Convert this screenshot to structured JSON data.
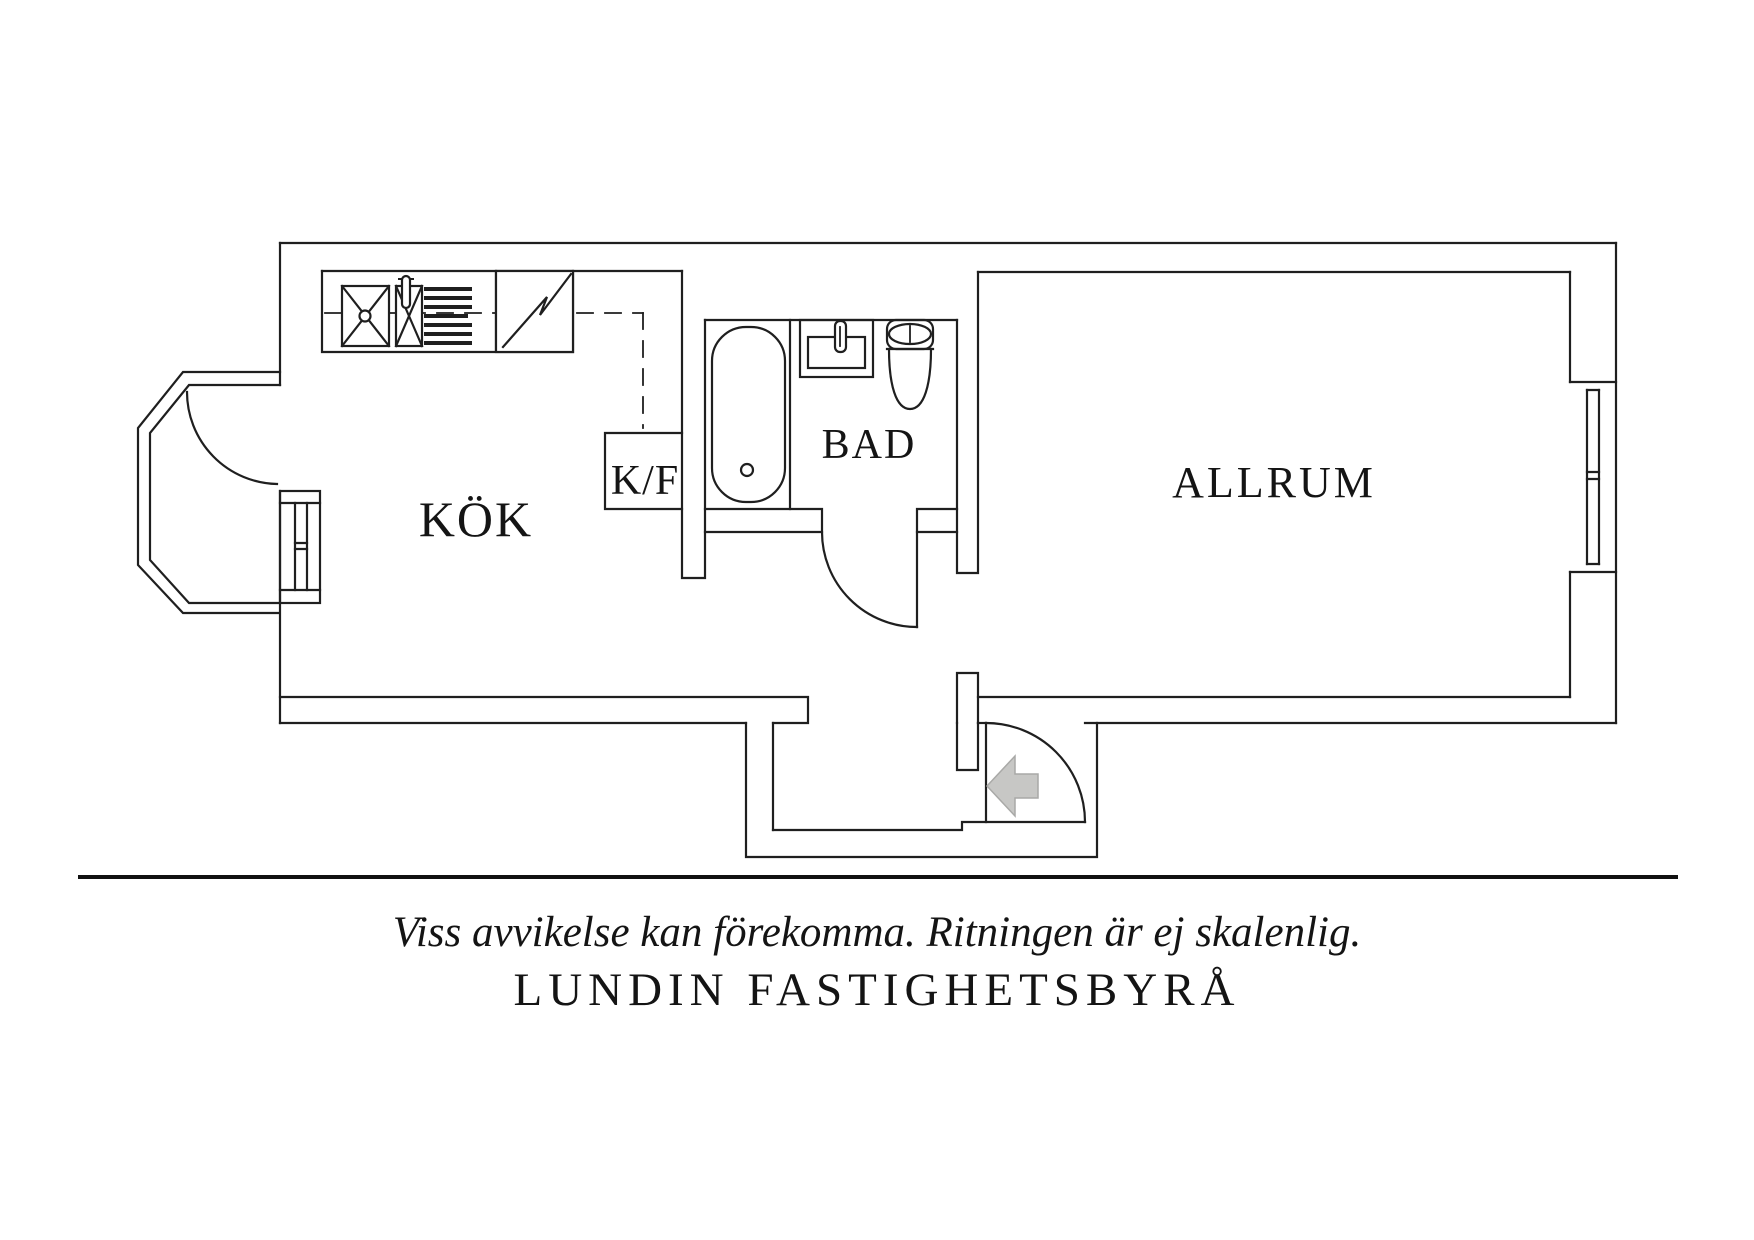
{
  "floorplan": {
    "rooms": [
      {
        "id": "kok",
        "label": "KÖK"
      },
      {
        "id": "kf",
        "label": "K/F"
      },
      {
        "id": "bad",
        "label": "BAD"
      },
      {
        "id": "allrum",
        "label": "ALLRUM"
      }
    ],
    "fixtures": [
      "kitchen-hob",
      "kitchen-sink",
      "kitchen-drainboard",
      "kitchen-worktop",
      "fridge-freezer",
      "bathtub",
      "washbasin",
      "toilet",
      "balcony",
      "entry-arrow",
      "west-window",
      "east-window"
    ],
    "colors": {
      "line": "#1f1f1f",
      "entry_arrow": "#c7c7c5",
      "background": "#ffffff",
      "divider": "#111111"
    }
  },
  "footer": {
    "disclaimer": "Viss avvikelse kan förekomma. Ritningen är ej skalenlig.",
    "company": "LUNDIN FASTIGHETSBYRÅ"
  }
}
